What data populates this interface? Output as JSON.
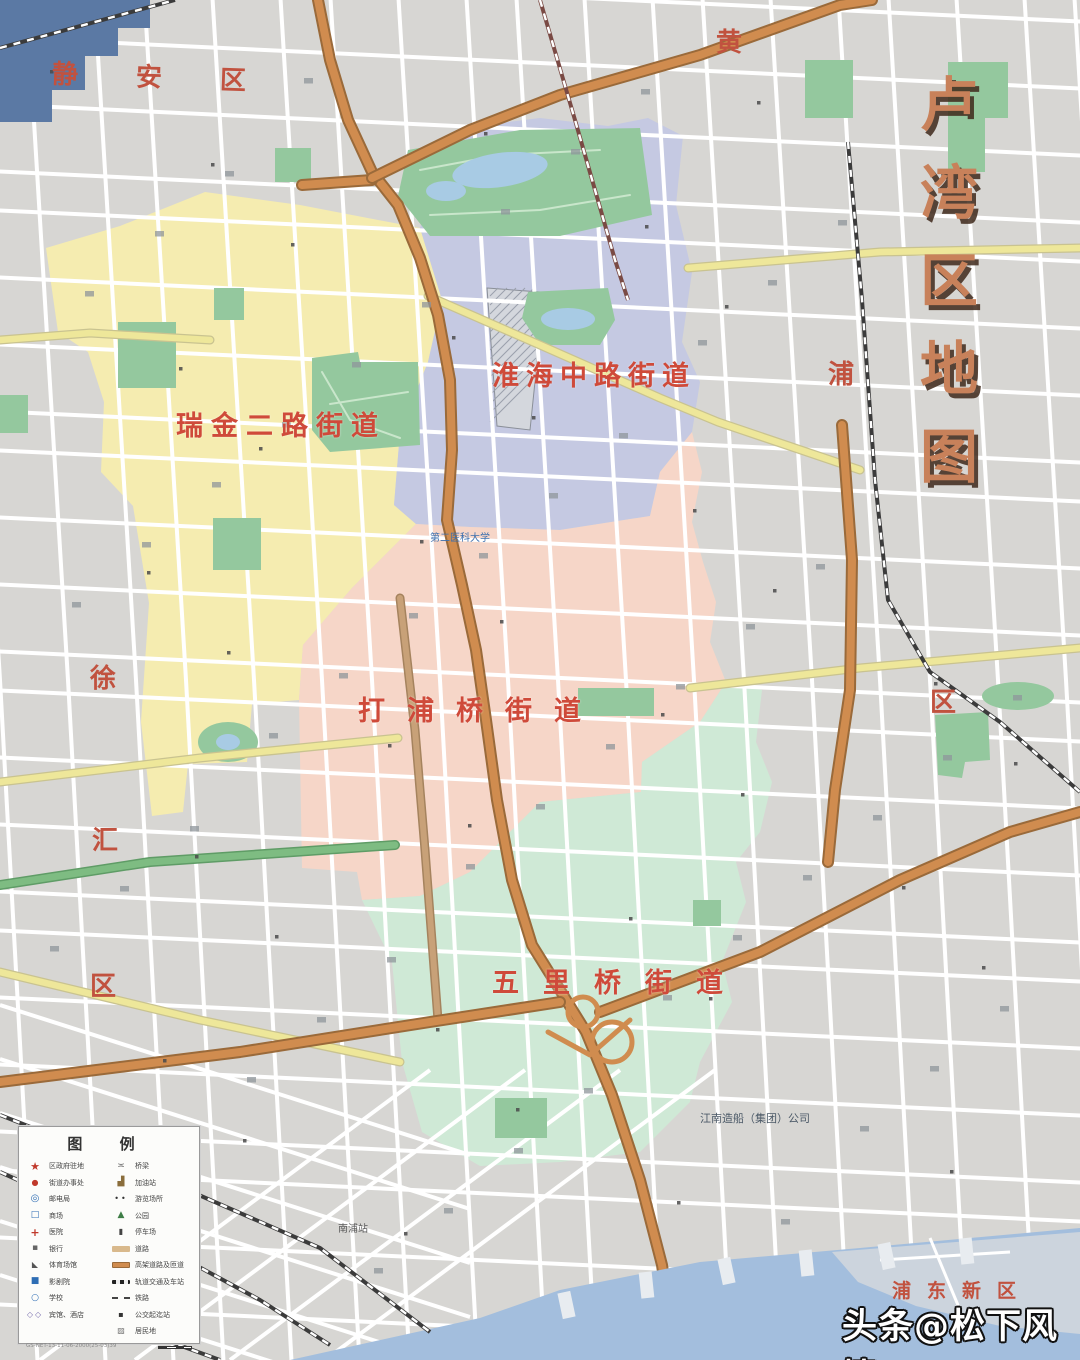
{
  "map_labels": {
    "title": "卢湾区地图",
    "districts": [
      {
        "id": "ruijin",
        "name": "瑞金二路街道"
      },
      {
        "id": "huaihai",
        "name": "淮海中路街道"
      },
      {
        "id": "dapuqiao",
        "name": "打浦桥街道"
      },
      {
        "id": "wuliqiao",
        "name": "五里桥街道"
      }
    ],
    "neighbors": [
      {
        "id": "jingan",
        "name": "静安区"
      },
      {
        "id": "huang",
        "name": "黄"
      },
      {
        "id": "pu",
        "name": "浦"
      },
      {
        "id": "qu-right",
        "name": "区"
      },
      {
        "id": "xu",
        "name": "徐"
      },
      {
        "id": "hui",
        "name": "汇"
      },
      {
        "id": "qu-left",
        "name": "区"
      },
      {
        "id": "pudong",
        "name": "浦东新区"
      }
    ],
    "pois": [
      {
        "id": "erda",
        "name": "第二医科大学"
      },
      {
        "id": "jiangnan",
        "name": "江南造船（集团）公司"
      },
      {
        "id": "nanpu",
        "name": "南浦站"
      }
    ]
  },
  "watermark": "头条@松下风情",
  "legend": {
    "title": "图 例",
    "left": [
      {
        "icon": "star-red-icon",
        "glyph": "★",
        "label": "区政府驻地"
      },
      {
        "icon": "dot-red-icon",
        "glyph": "●",
        "label": "街道办事处"
      },
      {
        "icon": "pin-blue-icon",
        "glyph": "◎",
        "label": "邮电局"
      },
      {
        "icon": "square-blue-icon",
        "glyph": "□",
        "label": "商场"
      },
      {
        "icon": "cross-red-icon",
        "glyph": "+",
        "label": "医院"
      },
      {
        "icon": "square-grey-icon",
        "glyph": "▪",
        "label": "银行"
      },
      {
        "icon": "bowtie-grey-icon",
        "glyph": "◣",
        "label": "体育场馆"
      },
      {
        "icon": "square-blue-fill-icon",
        "glyph": "■",
        "label": "影剧院"
      },
      {
        "icon": "circle-blue-icon",
        "glyph": "○",
        "label": "学校"
      },
      {
        "icon": "diamond-pair-icon",
        "glyph": "◇◇",
        "label": "宾馆、酒店"
      }
    ],
    "right": [
      {
        "icon": "bridge-icon",
        "glyph": "≍",
        "label": "桥梁"
      },
      {
        "icon": "pump-icon",
        "glyph": "▟",
        "label": "加油站"
      },
      {
        "icon": "dots-pair-icon",
        "glyph": "••",
        "label": "游览场所"
      },
      {
        "icon": "tree-icon",
        "glyph": "▲",
        "label": "公园"
      },
      {
        "icon": "block-dark-icon",
        "glyph": "▮",
        "label": "停车场"
      },
      {
        "icon": "bar-tan",
        "glyph": "",
        "label": "道路"
      },
      {
        "icon": "bar-orange",
        "glyph": "",
        "label": "高架道路及匝道"
      },
      {
        "icon": "bar-rail",
        "glyph": "",
        "label": "轨道交通及车站"
      },
      {
        "icon": "line-rail",
        "glyph": "",
        "label": "铁路"
      },
      {
        "icon": "dot-dark-icon",
        "glyph": "▪",
        "label": "公交起迄站"
      },
      {
        "icon": "hatch-icon",
        "glyph": "▨",
        "label": "居民地"
      }
    ],
    "note": "GS-NET-13-11-06-2000(25-03)39"
  },
  "colors": {
    "background": "#d7d6d3",
    "ruijin_fill": "#f5ecb0",
    "huaihai_fill": "#c5c9e2",
    "dapuqiao_fill": "#f6d6c8",
    "wuliqiao_fill": "#cfe9d6",
    "park": "#94c89e",
    "park_path": "#c9e6cb",
    "water": "#a3bedd",
    "water_dark": "#5b79a4",
    "pudong_land": "#ccd4dd",
    "road_major": "#d08c4f",
    "road_major_casing": "#9a6a3a",
    "road_yellow": "#eee79a",
    "road_green": "#7ebc82",
    "road_tan": "#c8a178",
    "road_minor": "#ffffff",
    "rail_dark": "#3b3b3b",
    "metro_red": "#7a4a44",
    "district_label": "#cf4a3a",
    "neighbor_label": "#c1523f",
    "title_fill": "#c8815a"
  }
}
